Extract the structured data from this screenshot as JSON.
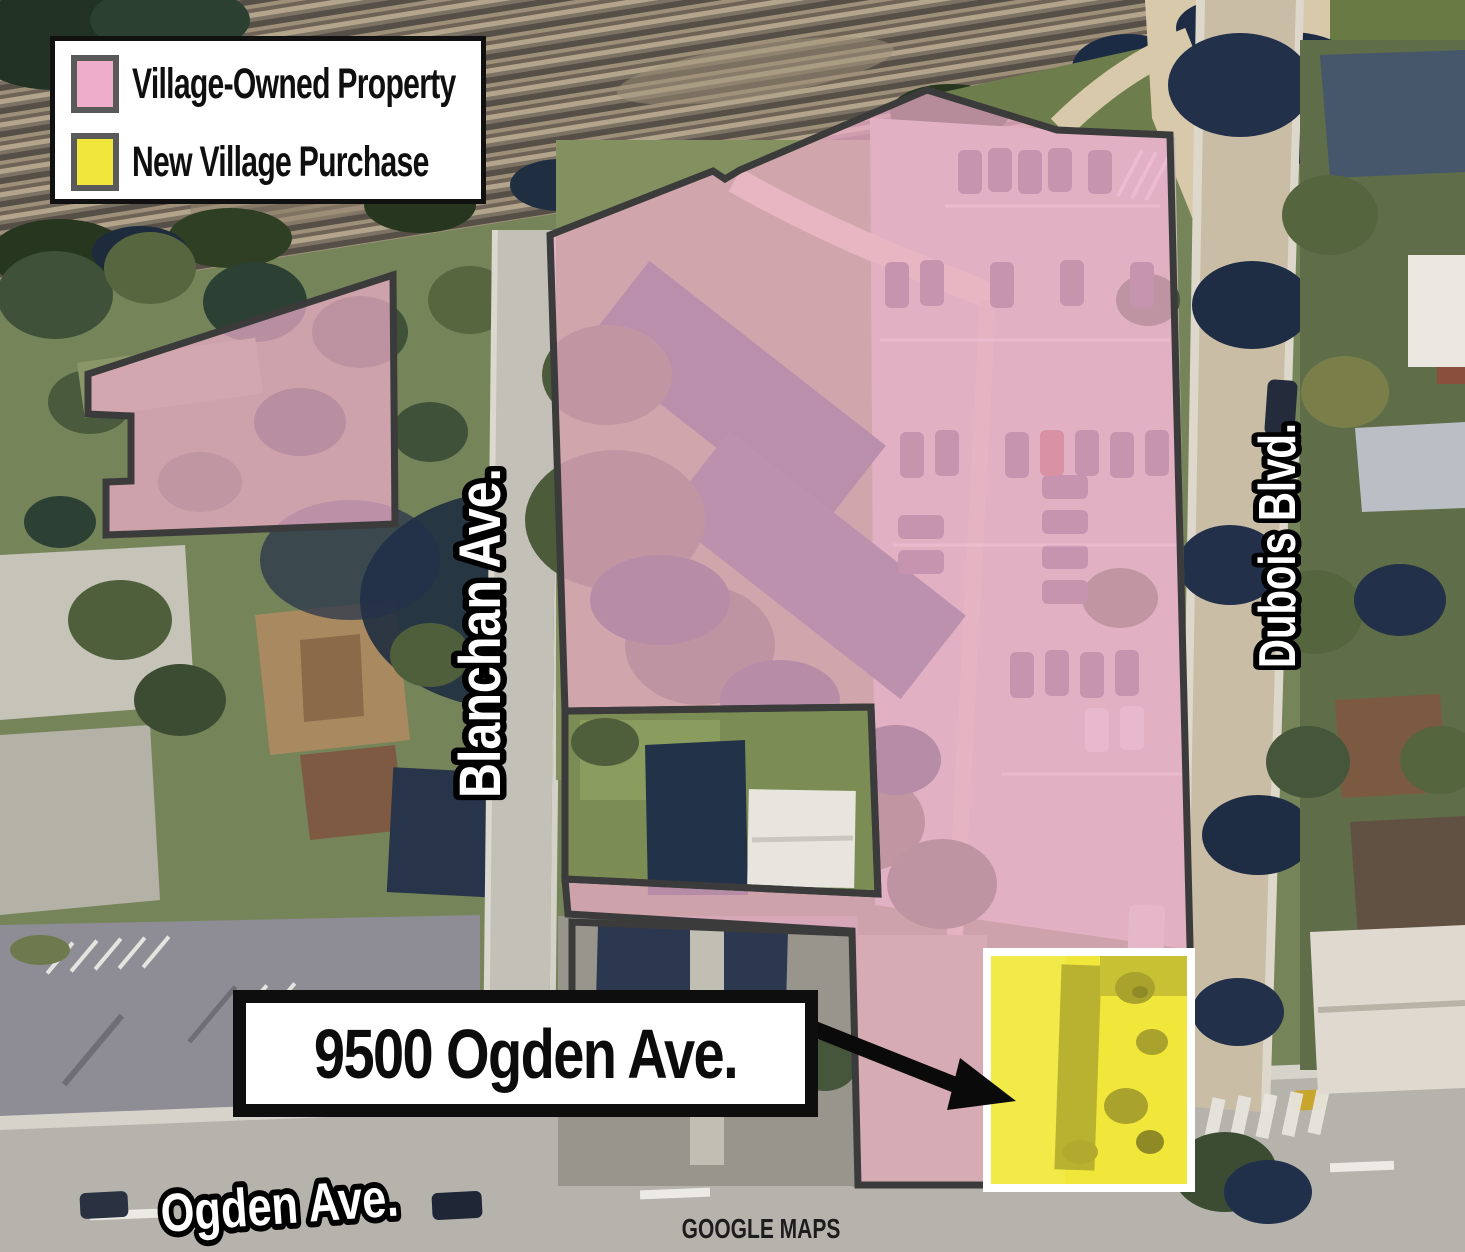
{
  "colors": {
    "village_owned": "#eeadcb",
    "new_purchase": "#f1e73a",
    "outline": "#3b3b3b",
    "swatch_border": "#5a5a5a",
    "callout_border": "#0e0e0e",
    "label_fill": "#ffffff",
    "label_stroke": "#000000"
  },
  "legend": {
    "items": [
      {
        "id": "village-owned",
        "label": "Village-Owned Property",
        "color": "#eeadcb"
      },
      {
        "id": "new-purchase",
        "label": "New Village Purchase",
        "color": "#f1e73a"
      }
    ]
  },
  "streets": {
    "blanchan": "Blanchan Ave.",
    "dubois": "Dubois Blvd.",
    "ogden": "Ogden Ave."
  },
  "callout": {
    "text": "9500 Ogden Ave."
  },
  "attribution": {
    "text": "GOOGLE MAPS"
  }
}
